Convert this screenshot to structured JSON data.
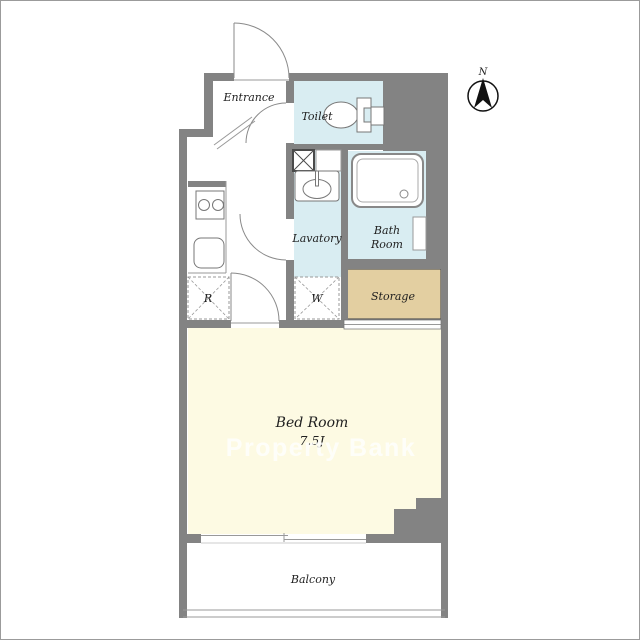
{
  "meta": {
    "type": "apartment-floor-plan",
    "watermark": "Property Bank",
    "compass_label": "N"
  },
  "rooms": {
    "entrance": {
      "label": "Entrance"
    },
    "toilet": {
      "label": "Toilet"
    },
    "lavatory": {
      "label": "Lavatory"
    },
    "bath_room": {
      "label_line1": "Bath",
      "label_line2": "Room"
    },
    "storage": {
      "label": "Storage"
    },
    "bed_room": {
      "label": "Bed Room",
      "size": "7.5J"
    },
    "balcony": {
      "label": "Balcony"
    }
  },
  "fixtures": {
    "refrigerator_label": "R",
    "washer_label": "W"
  },
  "colors": {
    "wall": "#838383",
    "wet_room_fill": "#d9edf2",
    "storage_fill": "#e3cfa1",
    "bedroom_fill": "#fdfae3",
    "line": "#999999",
    "watermark": "#ffffff"
  }
}
